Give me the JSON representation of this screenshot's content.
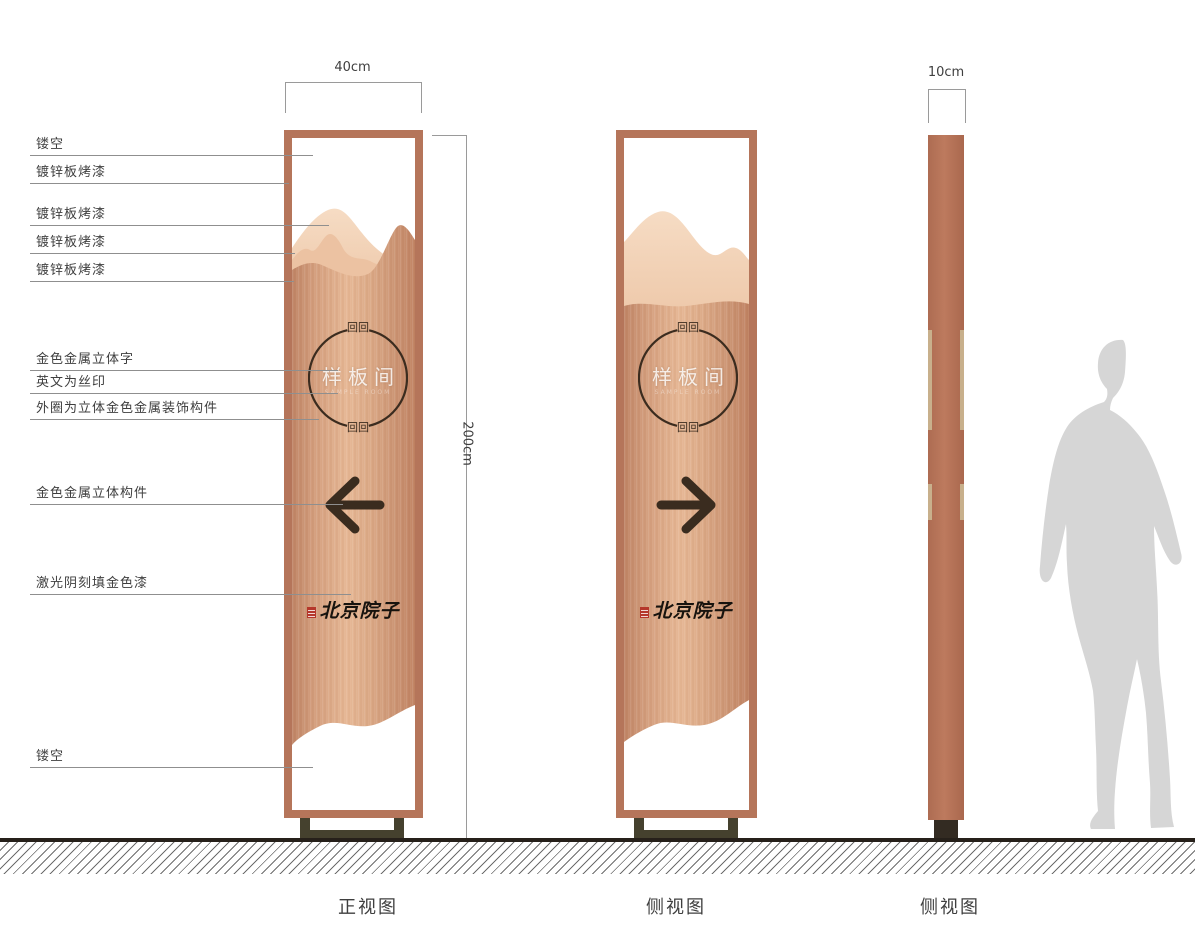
{
  "dimensions": {
    "front_width_label": "40cm",
    "height_label": "200cm",
    "side_width_label": "10cm"
  },
  "callouts": {
    "items": [
      {
        "label": "镂空"
      },
      {
        "label": "镀锌板烤漆"
      },
      {
        "label": "镀锌板烤漆"
      },
      {
        "label": "镀锌板烤漆"
      },
      {
        "label": "镀锌板烤漆"
      },
      {
        "label": "金色金属立体字"
      },
      {
        "label": "英文为丝印"
      },
      {
        "label": "外圈为立体金色金属装饰构件"
      },
      {
        "label": "金色金属立体构件"
      },
      {
        "label": "激光阴刻填金色漆"
      },
      {
        "label": "镂空"
      }
    ]
  },
  "sign": {
    "plaque_text": "样板间",
    "plaque_subtext": "SAMPLE ROOM",
    "ornament": "回回",
    "brand_text": "北京院子"
  },
  "views": {
    "front": "正视图",
    "side1": "侧视图",
    "side2": "侧视图"
  },
  "colors": {
    "frame_copper": "#b5755a",
    "panel_light": "#e6b794",
    "panel_dark": "#bf8465",
    "mountain_back": "#f3d4ba",
    "mountain_mid": "#ecc2a2",
    "detail_dark": "#3b2c1f",
    "gold_strip": "#c8b08c",
    "base_olive": "#45412e",
    "seal_red": "#b5372b",
    "silhouette_gray": "#d6d6d6",
    "ground_dark": "#26201a"
  }
}
